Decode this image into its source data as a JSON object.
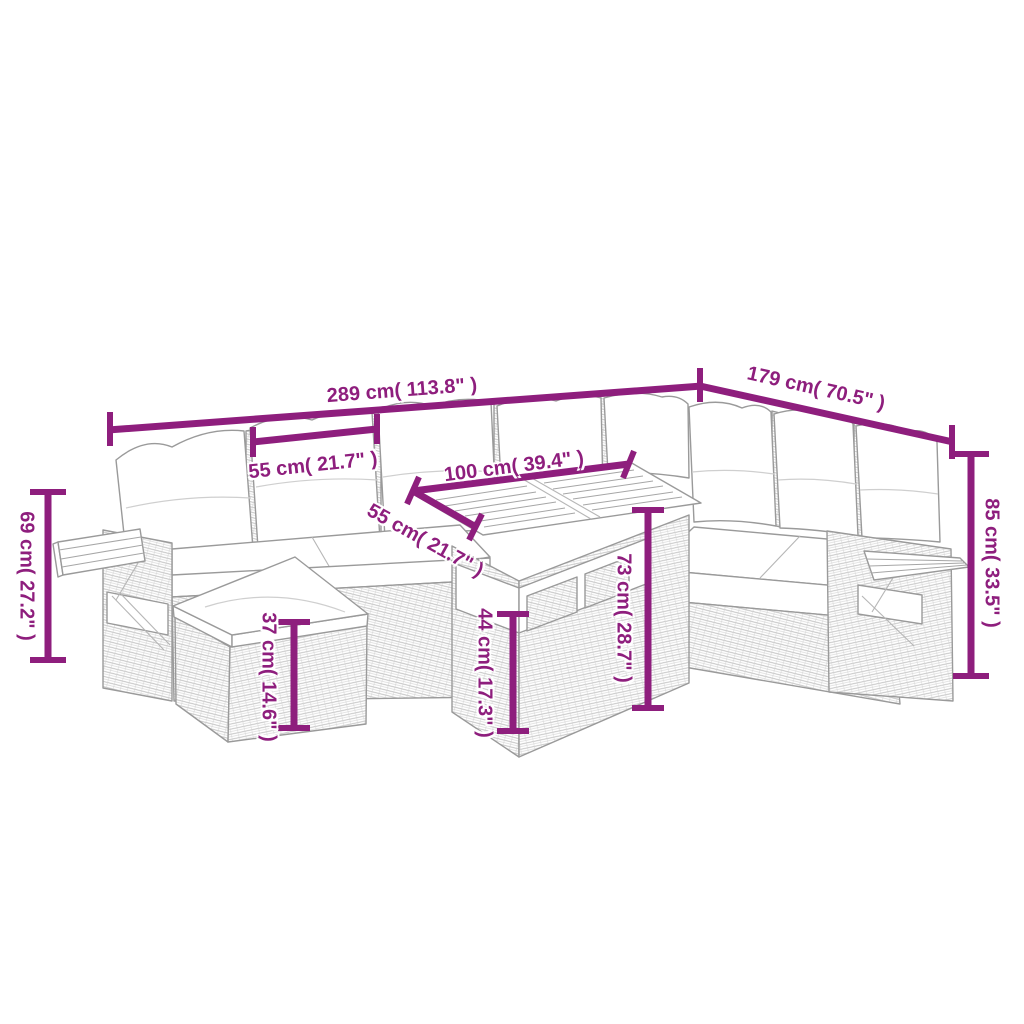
{
  "diagram": {
    "kind": "furniture-dimension-diagram",
    "subject": "Rattan garden lounge set with cushions, ottoman and wood-top table",
    "background_color": "#ffffff",
    "accent_color": "#8E1E7D",
    "sketch_color": "#9a9a9a"
  },
  "dims": {
    "overall_width": {
      "label": "289 cm( 113.8\" )"
    },
    "overall_depth": {
      "label": "179 cm( 70.5\" )"
    },
    "backrest_width": {
      "label": "55 cm( 21.7\" )"
    },
    "table_length": {
      "label": "100 cm( 39.4\" )"
    },
    "table_depth": {
      "label": "55 cm( 21.7\" )"
    },
    "table_height": {
      "label": "73 cm( 28.7\" )"
    },
    "table_base_height": {
      "label": "44 cm( 17.3\" )"
    },
    "total_height": {
      "label": "85 cm( 33.5\" )"
    },
    "armrest_height": {
      "label": "69 cm( 27.2\" )"
    },
    "ottoman_height": {
      "label": "37 cm( 14.6\" )"
    }
  }
}
